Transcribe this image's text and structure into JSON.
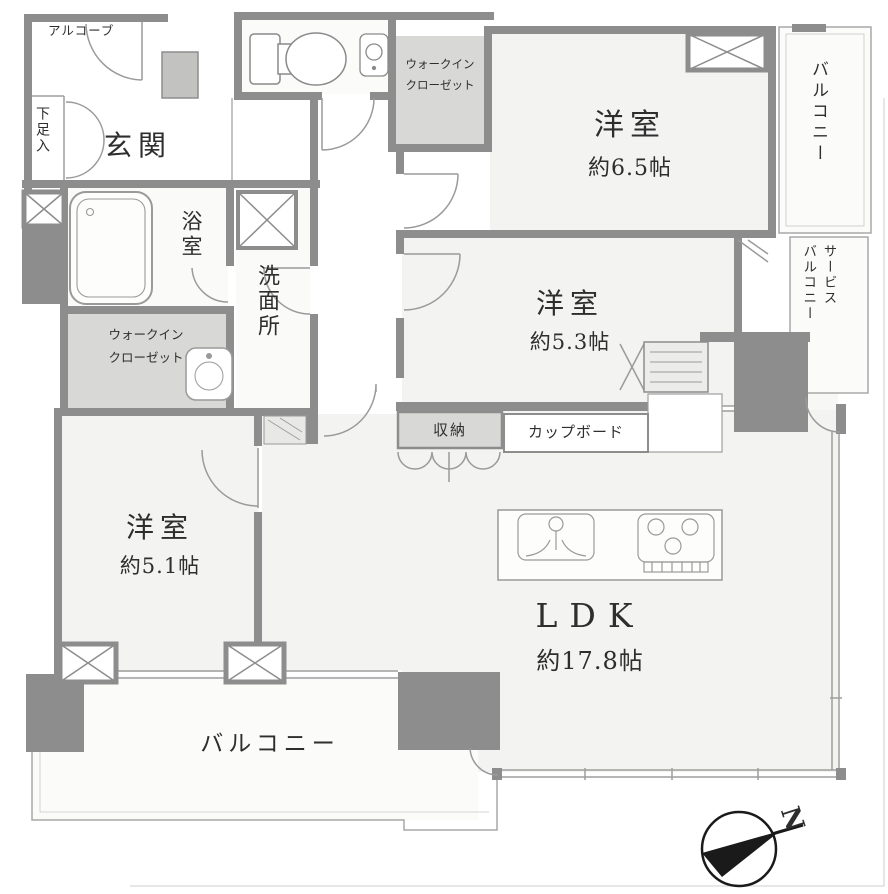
{
  "plan": {
    "rooms": {
      "entrance": "玄関",
      "alcove": "アルコーブ",
      "shoe_cabinet": "下足入",
      "bathroom": "浴室",
      "washroom": "洗面所",
      "wic_top": {
        "line1": "ウォークイン",
        "line2": "クローゼット"
      },
      "wic_left": {
        "line1": "ウォークイン",
        "line2": "クローゼット"
      },
      "bedroom_1": {
        "name": "洋室",
        "area": "約6.5帖"
      },
      "bedroom_2": {
        "name": "洋室",
        "area": "約5.3帖"
      },
      "bedroom_3": {
        "name": "洋室",
        "area": "約5.1帖"
      },
      "ldk": {
        "name": "LDK",
        "area": "約17.8帖"
      },
      "storage": "収納",
      "cupboard": "カップボード",
      "balcony_right": "バルコニー",
      "service_balcony": {
        "line1": "サービス",
        "line2": "バルコニー"
      },
      "balcony_bottom": "バルコニー"
    },
    "compass": {
      "label": "N"
    },
    "colors": {
      "wall": "#8d8d8d",
      "closet_fill": "#d8d8d6",
      "room_fill": "#f3f3f1",
      "balcony_fill": "#fbfbfa",
      "thin_line": "#9e9e9e",
      "text": "#2e2e2e",
      "compass": "#1a1a1a"
    }
  }
}
